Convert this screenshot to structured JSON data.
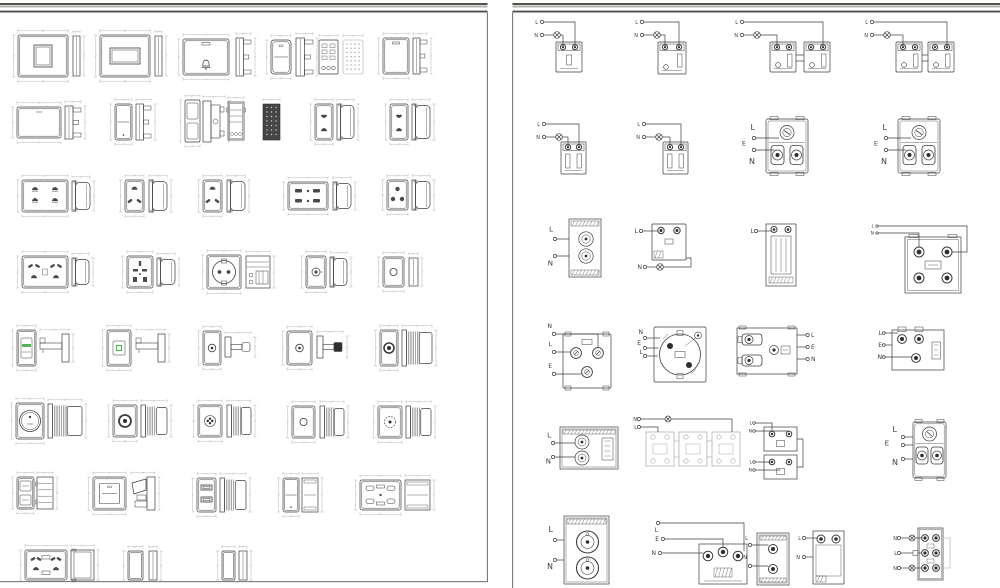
{
  "document": {
    "type": "cad-sheet-pair",
    "description": "Two CAD drawing sheets: left sheet = electrical switch/socket front and side view blocks with dimension lines; right sheet = wiring connection diagrams with L/N/E terminal labels",
    "colors": {
      "paper": "#ffffff",
      "line": "#3c3c3c",
      "dark": "#2e2e2e",
      "hole": "#4a4a4a",
      "dim": "#b4b4bc",
      "muted": "#a8a8a8",
      "green": "#56b35c",
      "frame": "#52524c",
      "border": "#6e6e66"
    }
  },
  "left_page": {
    "blocks": [
      [
        "plateSq",
        18,
        35,
        50,
        42,
        "thin",
        73,
        36,
        7,
        40
      ],
      [
        "plateRect",
        100,
        35,
        50,
        42,
        "thin",
        155,
        36,
        7,
        40
      ],
      [
        "plateBell",
        183,
        39,
        46,
        36,
        "bracket",
        236,
        38,
        15,
        38
      ],
      [
        "rocker",
        271,
        40,
        20,
        34,
        "bracket",
        296,
        38,
        17,
        38
      ],
      [
        "connGrid",
        319,
        40,
        19,
        34,
        "",
        0,
        0,
        0,
        0
      ],
      [
        "keypadDots",
        343,
        40,
        20,
        34,
        "",
        0,
        0,
        0,
        0
      ],
      [
        "plateDash",
        383,
        38,
        26,
        36,
        "bracket",
        413,
        38,
        14,
        36
      ],
      [
        "plateBlank",
        17,
        107,
        44,
        31,
        "bracket",
        65,
        106,
        16,
        33
      ],
      [
        "switchV",
        115,
        104,
        17,
        36,
        "bracket",
        136,
        104,
        15,
        36
      ],
      [
        "switch2V",
        185,
        100,
        15,
        42,
        "bracketLg",
        203,
        101,
        22,
        41
      ],
      [
        "relayMod",
        228,
        102,
        16,
        38,
        "",
        0,
        0,
        0,
        0
      ],
      [
        "darkGrid",
        263,
        104,
        17,
        36,
        "",
        0,
        0,
        0,
        0
      ],
      [
        "socket2",
        315,
        104,
        18,
        36,
        "drum",
        337,
        104,
        17,
        36
      ],
      [
        "socket2",
        390,
        104,
        18,
        36,
        "drum",
        412,
        104,
        18,
        36
      ],
      [
        "socket4W",
        22,
        180,
        46,
        32,
        "drum",
        72,
        181,
        18,
        30
      ],
      [
        "socket3",
        125,
        180,
        19,
        32,
        "drum",
        149,
        180,
        18,
        32
      ],
      [
        "socket3",
        203,
        180,
        19,
        32,
        "drum",
        227,
        180,
        18,
        32
      ],
      [
        "socket4S",
        288,
        182,
        40,
        28,
        "drum",
        333,
        182,
        18,
        28
      ],
      [
        "socket3R",
        387,
        180,
        21,
        30,
        "drum",
        412,
        180,
        18,
        30
      ],
      [
        "socketMulti",
        22,
        256,
        46,
        32,
        "drum",
        72,
        258,
        17,
        28
      ],
      [
        "socketUni",
        127,
        256,
        26,
        32,
        "drum",
        157,
        258,
        18,
        28
      ],
      [
        "schuko",
        207,
        255,
        34,
        34,
        "modDetail",
        246,
        256,
        24,
        32
      ],
      [
        "plateTv",
        306,
        256,
        20,
        32,
        "drum",
        330,
        257,
        17,
        30
      ],
      [
        "plateCir",
        383,
        257,
        21,
        30,
        "thin",
        409,
        258,
        9,
        28
      ],
      [
        "ledSwitch",
        17,
        330,
        19,
        36,
        "Lbracket",
        40,
        334,
        29,
        28
      ],
      [
        "sqSwitch",
        107,
        330,
        24,
        36,
        "Lbracket",
        136,
        334,
        29,
        28
      ],
      [
        "plateRing",
        203,
        331,
        18,
        34,
        "stem",
        225,
        337,
        26,
        20
      ],
      [
        "plateRing",
        287,
        331,
        25,
        34,
        "stemB",
        317,
        336,
        26,
        22
      ],
      [
        "plateXlr",
        380,
        330,
        18,
        36,
        "knurl",
        402,
        330,
        30,
        36
      ],
      [
        "knobBig",
        16,
        403,
        28,
        36,
        "knurlLg",
        48,
        404,
        34,
        34
      ],
      [
        "plateDotD",
        113,
        405,
        24,
        32,
        "knurl",
        141,
        405,
        26,
        32
      ],
      [
        "plateFlower",
        198,
        405,
        24,
        32,
        "knurl",
        227,
        405,
        24,
        32
      ],
      [
        "plateCir",
        292,
        406,
        23,
        32,
        "knurl",
        320,
        406,
        24,
        32
      ],
      [
        "plateDotted",
        378,
        406,
        24,
        32,
        "knurl",
        406,
        406,
        25,
        32
      ],
      [
        "switch2seg",
        17,
        477,
        17,
        32,
        "ribbed",
        37,
        477,
        16,
        32
      ],
      [
        "switch1gLg",
        93,
        477,
        33,
        33,
        "switchSide",
        131,
        477,
        24,
        33
      ],
      [
        "usb2",
        197,
        478,
        19,
        34,
        "knurl",
        220,
        478,
        26,
        34
      ],
      [
        "switchV",
        283,
        478,
        16,
        34,
        "clipside",
        302,
        478,
        16,
        34
      ],
      [
        "socket6",
        360,
        480,
        41,
        30,
        "clipside",
        405,
        480,
        25,
        30
      ],
      [
        "socketMulti2",
        25,
        550,
        42,
        30,
        "sideblock",
        71,
        550,
        23,
        30
      ],
      [
        "blankV",
        128,
        551,
        15,
        29,
        "thin",
        149,
        551,
        8,
        29
      ],
      [
        "blankV",
        222,
        551,
        13,
        29,
        "thin",
        239,
        551,
        8,
        29
      ]
    ]
  },
  "right_page": {
    "diagrams": [
      {
        "kind": "sw1",
        "labels": [
          "L",
          "N"
        ],
        "a": [
          538,
          22
        ],
        "m": [
          556,
          42,
          26,
          30
        ],
        "v": 1
      },
      {
        "kind": "sw1",
        "labels": [
          "L",
          "N"
        ],
        "a": [
          638,
          22
        ],
        "m": [
          658,
          42,
          28,
          32
        ],
        "v": 2
      },
      {
        "kind": "sw2",
        "labels": [
          "L",
          "N"
        ],
        "a": [
          738,
          22
        ],
        "m": [
          770,
          42,
          26,
          30
        ],
        "m2": [
          804,
          42,
          26,
          30
        ]
      },
      {
        "kind": "sw2",
        "labels": [
          "L",
          "N"
        ],
        "a": [
          868,
          22
        ],
        "m": [
          896,
          42,
          26,
          30
        ],
        "m2": [
          928,
          42,
          26,
          30
        ]
      },
      {
        "kind": "sw1",
        "labels": [
          "L",
          "N"
        ],
        "a": [
          540,
          124
        ],
        "m": [
          561,
          142,
          25,
          32
        ],
        "v": 3
      },
      {
        "kind": "sw1",
        "labels": [
          "L",
          "N"
        ],
        "a": [
          640,
          124
        ],
        "m": [
          663,
          142,
          25,
          32
        ],
        "v": 3
      },
      {
        "kind": "sockBack",
        "labels": [
          "L",
          "E",
          "N"
        ],
        "m": [
          766,
          119,
          42,
          54
        ]
      },
      {
        "kind": "sockBack",
        "labels": [
          "L",
          "E",
          "N"
        ],
        "m": [
          898,
          119,
          42,
          54
        ]
      },
      {
        "kind": "xlr2",
        "labels": [
          "L",
          "N"
        ],
        "m": [
          569,
          219,
          32,
          58
        ]
      },
      {
        "kind": "swLampDown",
        "labels": [
          "L",
          "N"
        ],
        "m": [
          652,
          224,
          34,
          36
        ]
      },
      {
        "kind": "tmod",
        "labels": [
          "L"
        ],
        "m": [
          766,
          224,
          30,
          62
        ]
      },
      {
        "kind": "tb4",
        "labels": [
          "L",
          "N"
        ],
        "m": [
          905,
          237,
          56,
          56
        ]
      },
      {
        "kind": "p3sq",
        "labels": [
          "N",
          "L",
          "E"
        ],
        "m": [
          563,
          334,
          48,
          54
        ]
      },
      {
        "kind": "schukoB",
        "labels": [
          "N",
          "E",
          "L"
        ],
        "m": [
          654,
          327,
          52,
          55
        ]
      },
      {
        "kind": "wideModR",
        "labels": [
          "L",
          "E",
          "N"
        ],
        "m": [
          737,
          328,
          60,
          46
        ]
      },
      {
        "kind": "modLEN",
        "labels": [
          "L",
          "E",
          "N"
        ],
        "m": [
          892,
          330,
          52,
          40
        ]
      },
      {
        "kind": "wideMod2",
        "labels": [
          "L",
          "N"
        ],
        "m": [
          560,
          427,
          58,
          42
        ]
      },
      {
        "kind": "chain3",
        "labels": [
          "N",
          "L"
        ],
        "m": [
          646,
          432,
          28,
          34
        ]
      },
      {
        "kind": "stack2",
        "labels": [
          "L",
          "N",
          "L",
          "N"
        ],
        "m": [
          764,
          427,
          33,
          24
        ],
        "m2": [
          764,
          455,
          33,
          24
        ]
      },
      {
        "kind": "sockBack2",
        "labels": [
          "L",
          "E",
          "N"
        ],
        "m": [
          913,
          422,
          33,
          56
        ]
      },
      {
        "kind": "xlr2b",
        "labels": [
          "L",
          "N"
        ],
        "m": [
          564,
          516,
          45,
          68
        ]
      },
      {
        "kind": "mod3t",
        "labels": [
          "L",
          "E",
          "N"
        ],
        "m": [
          699,
          544,
          48,
          40
        ]
      },
      {
        "kind": "pairMod",
        "labels": [
          "L",
          "N",
          "L",
          "N"
        ],
        "m": [
          757,
          533,
          32,
          52
        ],
        "m2": [
          813,
          531,
          31,
          53
        ]
      },
      {
        "kind": "multi6",
        "labels": [
          "N",
          "L",
          "N"
        ],
        "m": [
          918,
          528,
          25,
          52
        ]
      }
    ]
  }
}
